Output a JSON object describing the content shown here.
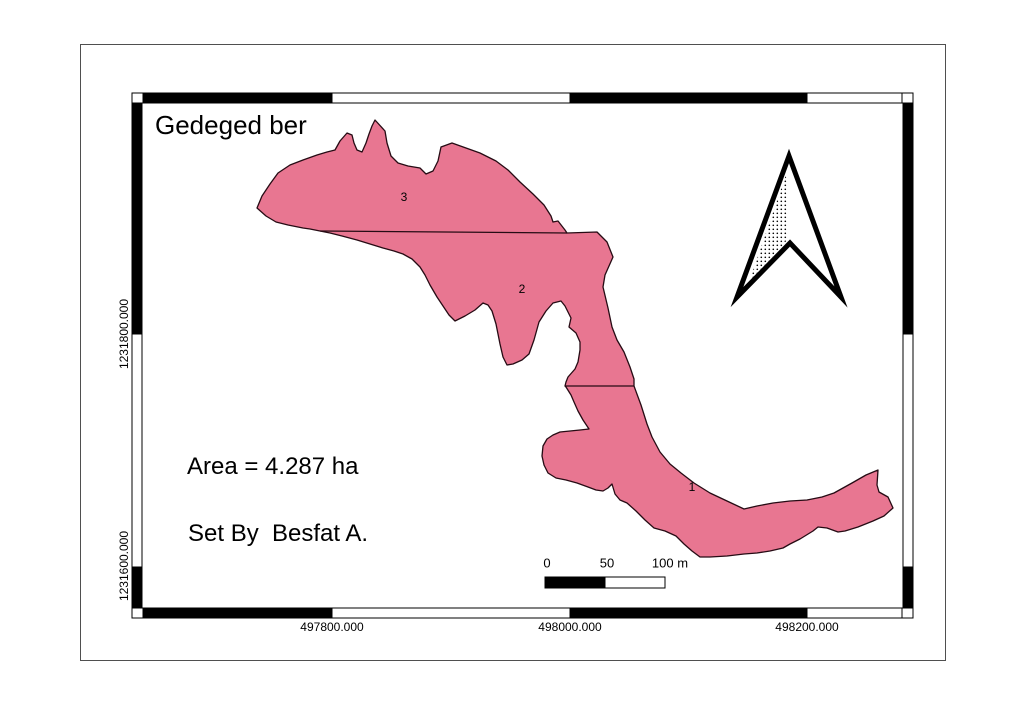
{
  "page": {
    "background": "#ffffff",
    "border_color": "#4f4f4f"
  },
  "map": {
    "title": "Gedeged ber",
    "area_text": "Area = 4.287 ha",
    "credit_text": "Set By  Besfat A.",
    "frame_colors": {
      "dark": "#000000",
      "light": "#ffffff"
    },
    "parcel": {
      "fill": "#e87691",
      "stroke": "#260b14",
      "points": "375,120 385,131 387,143 391,156 398,163 408,166 420,168 426,174 433,171 438,161 441,147 452,143 466,148 480,153 496,161 508,170 520,182 533,194 544,205 551,216 553,222 558,221 565,230 567,233 597,232 607,242 613,257 605,275 603,287 608,308 612,327 617,340 624,352 630,367 634,379 634,386 641,405 647,424 652,437 660,452 670,464 681,473 694,483 710,493 727,501 744,509 757,506 773,503 790,501 807,500 822,497 834,493 852,483 866,475 878,470 877,485 879,492 888,497 893,508 884,516 873,521 858,527 845,531 838,532 827,528 818,527 813,531 800,539 790,544 783,548 770,551 757,553 744,554 727,556 710,557 700,557 692,551 684,544 676,536 665,531 654,528 645,520 636,511 627,503 620,500 615,494 612,484 608,488 603,491 596,490 588,487 577,483 566,480 556,478 548,473 544,465 542,456 543,446 547,439 553,435 560,432 570,431 580,430 589,429 583,420 578,411 574,402 571,395 566,387 565,386 566,382 568,377 575,369 578,362 580,350 580,342 576,333 569,327 571,318 565,306 561,301 553,303 546,311 539,322 534,340 529,354 522,360 513,364 507,365 503,357 500,344 496,324 492,311 488,305 483,303 475,310 465,316 455,321 449,315 443,306 437,297 430,285 425,275 420,267 412,259 403,254 394,251 383,248 370,244 357,240 342,236 330,233 320,231 310,229 303,228 288,225 276,222 266,216 257,208 262,196 270,184 278,173 290,165 303,160 317,155 327,152 335,150 340,141 347,133 352,135 354,143 357,150 362,152 366,143 369,134 372,126",
      "divider_between_3_and_2": "320,231 567,233",
      "divider_between_2_and_1": "565,386 634,386",
      "labels": [
        {
          "text": "3"
        },
        {
          "text": "2"
        },
        {
          "text": "1"
        }
      ]
    },
    "grid": {
      "x_labels": [
        "497800.000",
        "498000.000",
        "498200.000"
      ],
      "y_labels": [
        "1231800.000",
        "1231600.000"
      ]
    },
    "scalebar": {
      "tick_labels": [
        "0",
        "50",
        "100 m"
      ]
    },
    "north_arrow": {
      "icon": "north-arrow"
    }
  }
}
